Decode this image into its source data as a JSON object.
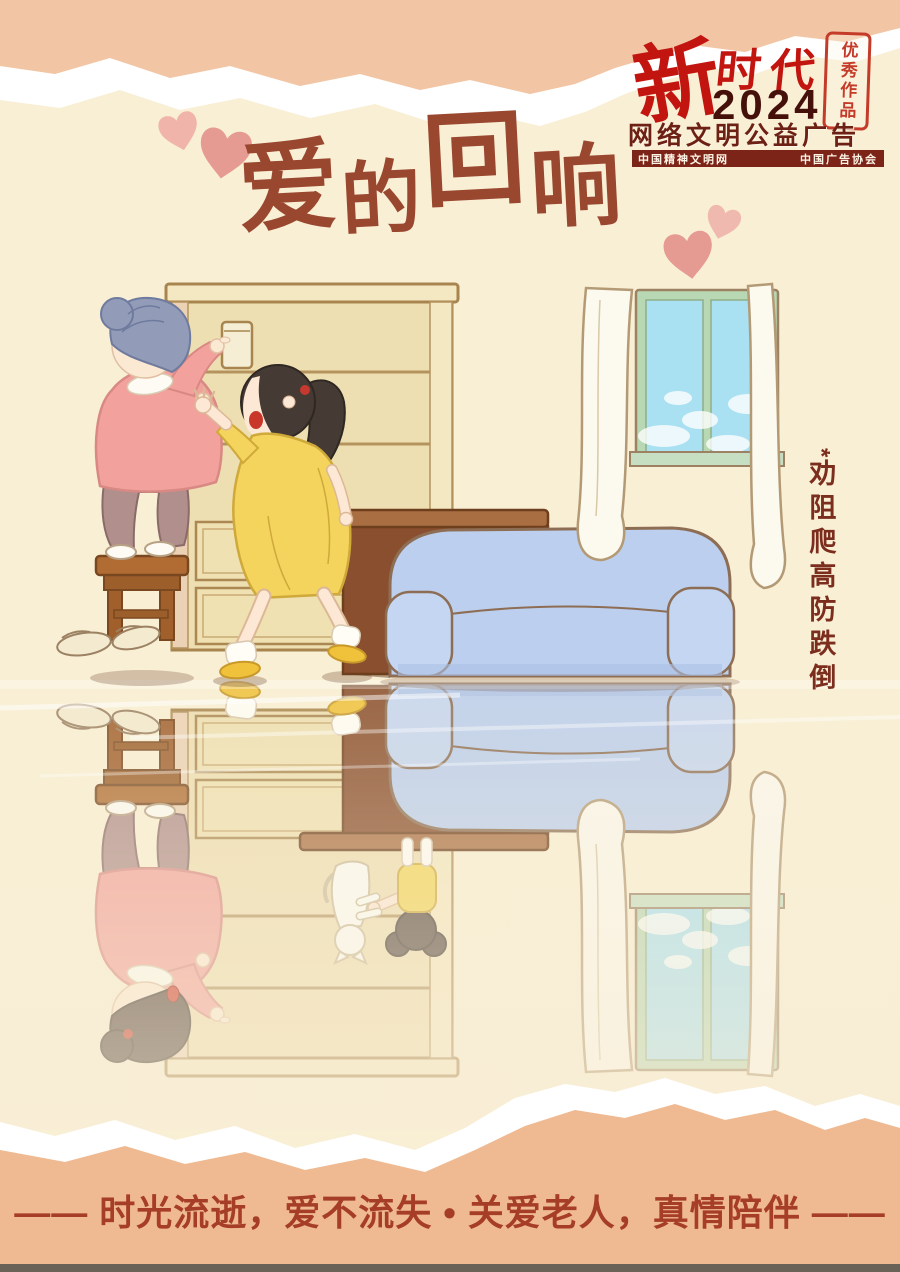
{
  "badge": {
    "brand_top": "新",
    "brand_rest": "时代",
    "year": "2024",
    "seal": "优秀作品",
    "subtitle": "网络文明公益广告",
    "org_left": "中国精神文明网",
    "org_right": "中国广告协会"
  },
  "title_chars": [
    "爱",
    "的",
    "回",
    "响"
  ],
  "side_note": {
    "marker": "*",
    "text": "劝阻爬高防跌倒"
  },
  "tagline": "—— 时光流逝，爱不流失 • 关爱老人，真情陪伴 ——",
  "scene": {
    "description_icons": [
      "bookshelf",
      "glass-jar",
      "wooden-stool",
      "grandma-reaching",
      "girl-stopping",
      "wooden-table",
      "blue-sofa",
      "window-with-curtains",
      "slippers",
      "mirror-reflection",
      "child-on-table",
      "white-cat"
    ]
  },
  "colors": {
    "background_cream": "#f9efd5",
    "torn_band_top": "#f2c5a5",
    "torn_band_bottom": "#efb992",
    "bottom_strip": "#6b6257",
    "brand_red": "#c2150f",
    "year_maroon": "#45100a",
    "subtitle_maroon": "#6d2014",
    "orgs_bar_bg": "#7d2418",
    "title_brown": "#9a4730",
    "side_note_brown": "#7c2e1e",
    "tagline_red": "#a63d26",
    "heart_pink": "#e59a92",
    "sofa_blue": "#bccfee",
    "window_green": "#b8d7b3",
    "sky_blue": "#a9e0f2",
    "sweater_pink": "#f2a19c",
    "dress_yellow": "#f4d45c",
    "hair_gray": "#929cb8",
    "wood_brown": "#a96f42"
  }
}
